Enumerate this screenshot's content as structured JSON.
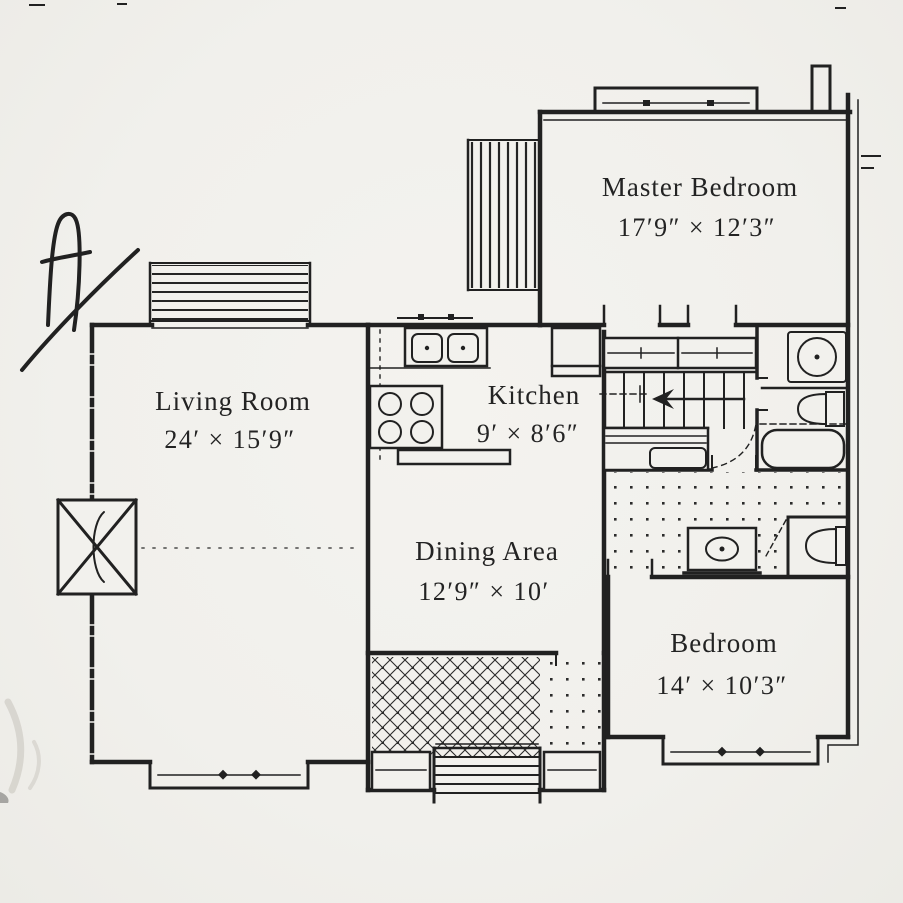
{
  "document": {
    "kind": "scanned first-floor plan",
    "annotation_mark": "A",
    "ink_color": "#212121",
    "paper_color": "#f1f0ec"
  },
  "rooms": [
    {
      "name": "Master Bedroom",
      "dims": "17′9″ × 12′3″"
    },
    {
      "name": "Living Room",
      "dims": "24′ × 15′9″"
    },
    {
      "name": "Kitchen",
      "dims": "9′ × 8′6″"
    },
    {
      "name": "Dining Area",
      "dims": "12′9″ × 10′"
    },
    {
      "name": "Bedroom",
      "dims": "14′ × 10′3″"
    }
  ]
}
